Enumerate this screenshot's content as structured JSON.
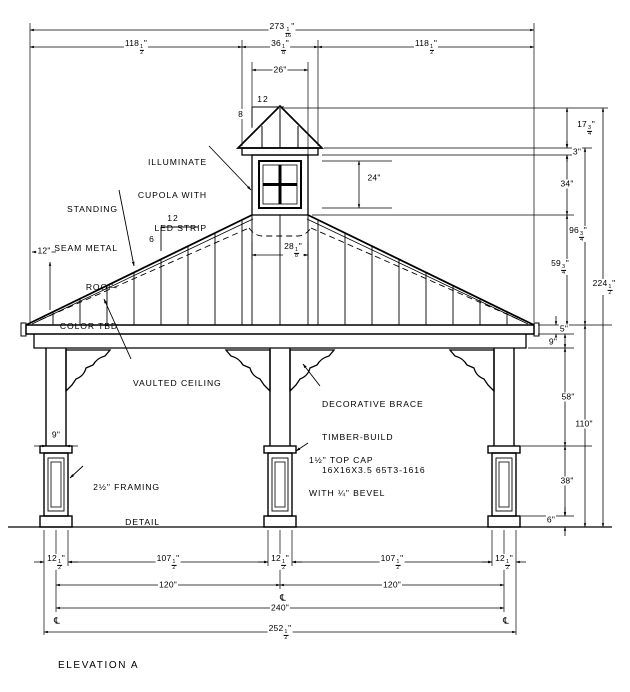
{
  "title": "ELEVATION A",
  "colors": {
    "ink": "#000000",
    "paper": "#ffffff"
  },
  "symbols": {
    "centerline": "℄"
  },
  "slopes": {
    "main": {
      "run": "12",
      "rise": "6"
    },
    "cupola": {
      "run": "12",
      "rise": "8"
    }
  },
  "labels": {
    "illuminate": [
      "ILLUMINATE",
      "CUPOLA WITH",
      "LED STRIP"
    ],
    "roof": [
      "STANDING",
      "SEAM METAL",
      "ROOF-",
      "COLOR TBD"
    ],
    "vaulted": "VAULTED CEILING",
    "brace": [
      "DECORATIVE BRACE",
      "TIMBER-BUILD",
      "16X16X3.5 65T3-1616"
    ],
    "topcap": [
      "1½\" TOP CAP",
      "WITH ¼\" BEVEL"
    ],
    "framing": [
      "2½\" FRAMING",
      "DETAIL"
    ]
  },
  "dims": {
    "overall_width_top": {
      "w": "273",
      "n": "1",
      "d": "16",
      "u": "\""
    },
    "span_left": {
      "w": "118",
      "n": "1",
      "d": "2",
      "u": "\""
    },
    "cupola_overall": {
      "w": "36",
      "n": "1",
      "d": "8",
      "u": "\""
    },
    "span_right": {
      "w": "118",
      "n": "1",
      "d": "2",
      "u": "\""
    },
    "cupola_body_width": {
      "w": "26",
      "u": "\""
    },
    "window_height": {
      "w": "24",
      "u": "\""
    },
    "cupola_interior": {
      "w": "28",
      "n": "1",
      "d": "8",
      "u": "\""
    },
    "roof_overhang": {
      "w": "12",
      "u": "\""
    },
    "cupola_roof_height": {
      "w": "17",
      "n": "3",
      "d": "4",
      "u": "\""
    },
    "cupola_fascia": {
      "w": "3",
      "u": "\""
    },
    "cupola_height": {
      "w": "34",
      "u": "\""
    },
    "roof_height": {
      "w": "59",
      "n": "3",
      "d": "4",
      "u": "\""
    },
    "cupola_total": {
      "w": "96",
      "n": "3",
      "d": "4",
      "u": "\""
    },
    "overall_height": {
      "w": "224",
      "n": "1",
      "d": "2",
      "u": "\""
    },
    "fascia_height": {
      "w": "5",
      "u": "\""
    },
    "beam_depth": {
      "w": "9",
      "u": "\""
    },
    "post_clear": {
      "w": "58",
      "u": "\""
    },
    "post_total": {
      "w": "110",
      "u": "\""
    },
    "base_height": {
      "w": "38",
      "u": "\""
    },
    "plinth_height": {
      "w": "6",
      "u": "\""
    },
    "post_width": {
      "w": "9",
      "u": "\""
    },
    "base_width": {
      "w": "12",
      "n": "1",
      "d": "2",
      "u": "\""
    },
    "post_spacing": {
      "w": "107",
      "n": "1",
      "d": "2",
      "u": "\""
    },
    "bay_cc": {
      "w": "120",
      "u": "\""
    },
    "span_cc": {
      "w": "240",
      "u": "\""
    },
    "overall_base": {
      "w": "252",
      "n": "1",
      "d": "2",
      "u": "\""
    }
  }
}
